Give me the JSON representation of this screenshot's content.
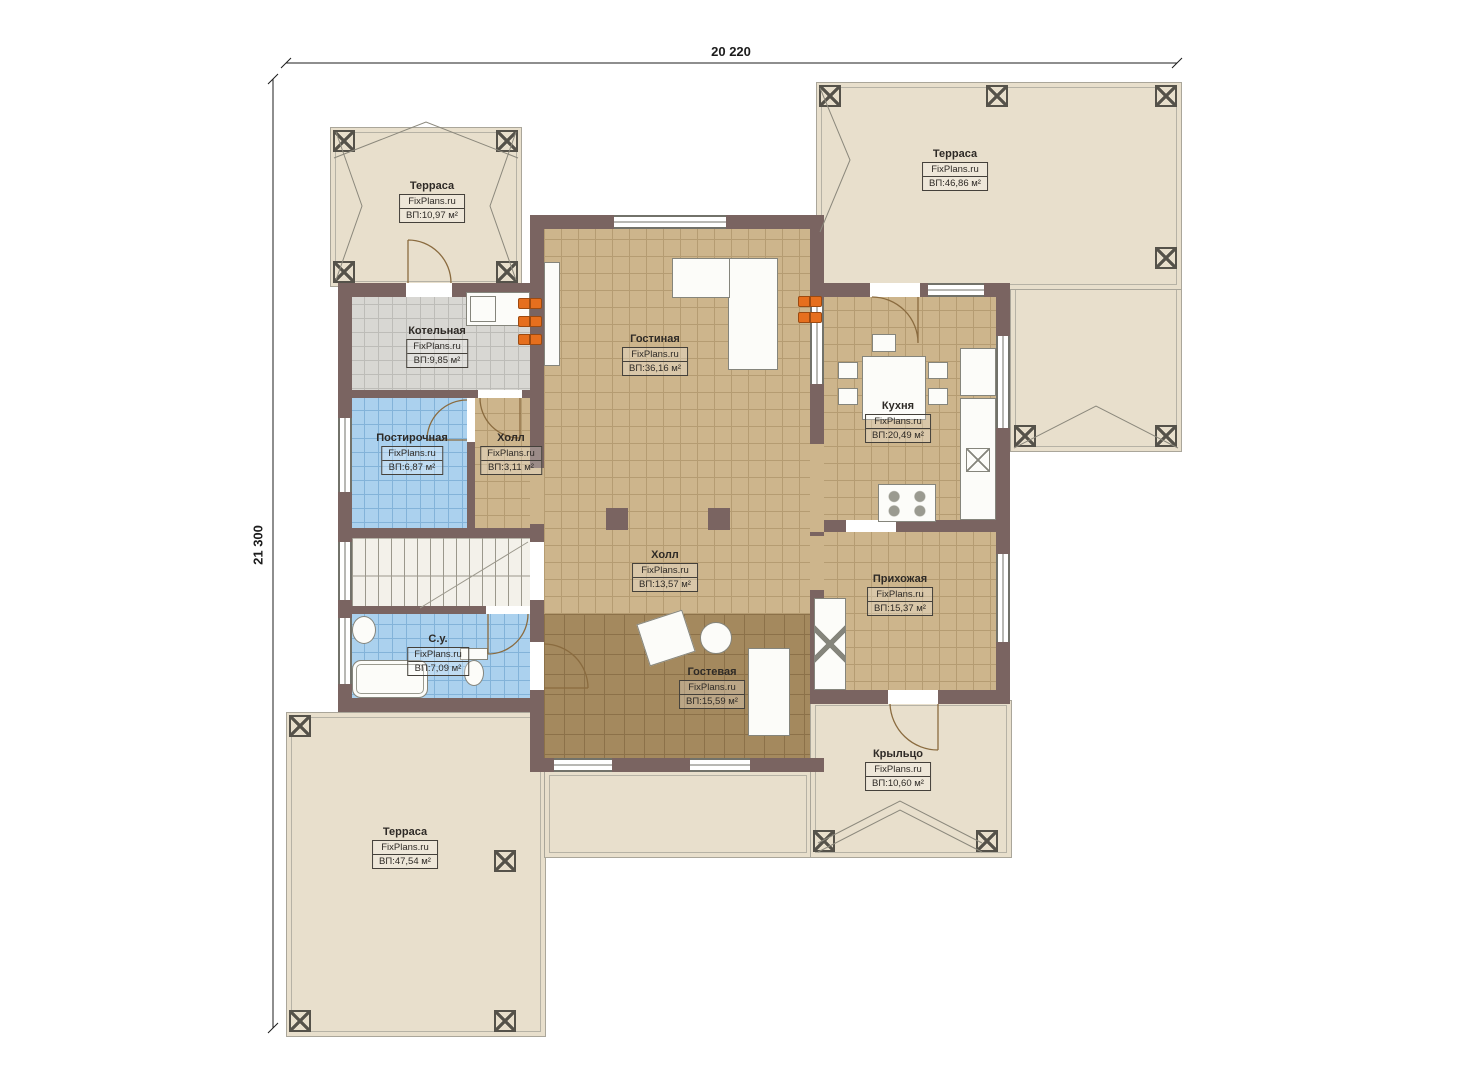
{
  "watermark": "FixPlans.ru",
  "dimensions": {
    "top": "20 220",
    "left": "21 300"
  },
  "rooms": [
    {
      "id": "terrace-top-left",
      "name": "Терраса",
      "area": "ВП:10,97 м²"
    },
    {
      "id": "terrace-top-right",
      "name": "Терраса",
      "area": "ВП:46,86 м²"
    },
    {
      "id": "boiler",
      "name": "Котельная",
      "area": "ВП:9,85 м²"
    },
    {
      "id": "living",
      "name": "Гостиная",
      "area": "ВП:36,16 м²"
    },
    {
      "id": "kitchen",
      "name": "Кухня",
      "area": "ВП:20,49 м²"
    },
    {
      "id": "laundry",
      "name": "Постирочная",
      "area": "ВП:6,87 м²"
    },
    {
      "id": "hall-small",
      "name": "Холл",
      "area": "ВП:3,11 м²"
    },
    {
      "id": "hall",
      "name": "Холл",
      "area": "ВП:13,57 м²"
    },
    {
      "id": "entry",
      "name": "Прихожая",
      "area": "ВП:15,37 м²"
    },
    {
      "id": "bathroom",
      "name": "С.у.",
      "area": "ВП:7,09 м²"
    },
    {
      "id": "guest",
      "name": "Гостевая",
      "area": "ВП:15,59 м²"
    },
    {
      "id": "porch",
      "name": "Крыльцо",
      "area": "ВП:10,60 м²"
    },
    {
      "id": "terrace-bottom",
      "name": "Терраса",
      "area": "ВП:47,54 м²"
    }
  ],
  "colors": {
    "wall": "#7a6461",
    "terrace": "#e8dfcc",
    "floor_tan": "#cdb58c",
    "floor_gray": "#d8d7d3",
    "floor_blue": "#abd1ee",
    "floor_parquet": "#a4895e",
    "radiator_accent": "#e66f1e"
  }
}
